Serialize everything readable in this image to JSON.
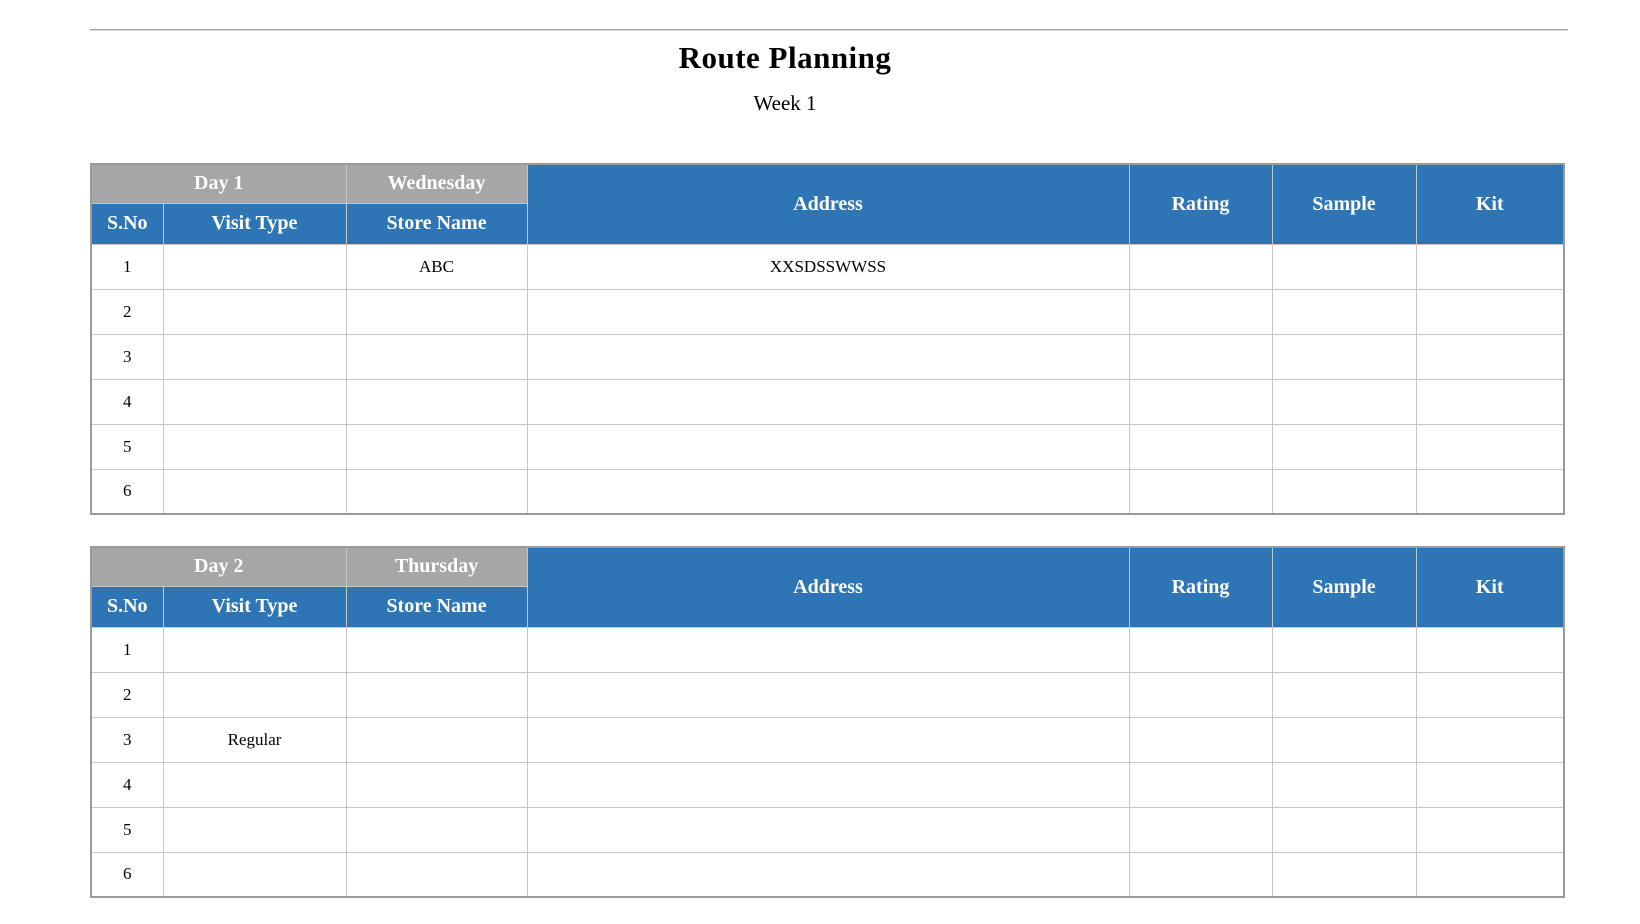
{
  "header": {
    "title": "Route Planning",
    "subtitle": "Week 1"
  },
  "columns": [
    {
      "key": "sno",
      "label": "S.No"
    },
    {
      "key": "visit_type",
      "label": "Visit Type"
    },
    {
      "key": "store_name",
      "label": "Store Name"
    },
    {
      "key": "address",
      "label": "Address"
    },
    {
      "key": "rating",
      "label": "Rating"
    },
    {
      "key": "sample",
      "label": "Sample"
    },
    {
      "key": "kit",
      "label": "Kit"
    }
  ],
  "tables": [
    {
      "day_label": "Day 1",
      "day_name": "Wednesday",
      "rows": [
        {
          "sno": "1",
          "visit_type": "",
          "store_name": "ABC",
          "address": "XXSDSSWWSS",
          "rating": "",
          "sample": "",
          "kit": ""
        },
        {
          "sno": "2",
          "visit_type": "",
          "store_name": "",
          "address": "",
          "rating": "",
          "sample": "",
          "kit": ""
        },
        {
          "sno": "3",
          "visit_type": "",
          "store_name": "",
          "address": "",
          "rating": "",
          "sample": "",
          "kit": ""
        },
        {
          "sno": "4",
          "visit_type": "",
          "store_name": "",
          "address": "",
          "rating": "",
          "sample": "",
          "kit": ""
        },
        {
          "sno": "5",
          "visit_type": "",
          "store_name": "",
          "address": "",
          "rating": "",
          "sample": "",
          "kit": ""
        },
        {
          "sno": "6",
          "visit_type": "",
          "store_name": "",
          "address": "",
          "rating": "",
          "sample": "",
          "kit": ""
        }
      ]
    },
    {
      "day_label": "Day 2",
      "day_name": "Thursday",
      "rows": [
        {
          "sno": "1",
          "visit_type": "",
          "store_name": "",
          "address": "",
          "rating": "",
          "sample": "",
          "kit": ""
        },
        {
          "sno": "2",
          "visit_type": "",
          "store_name": "",
          "address": "",
          "rating": "",
          "sample": "",
          "kit": ""
        },
        {
          "sno": "3",
          "visit_type": "Regular",
          "store_name": "",
          "address": "",
          "rating": "",
          "sample": "",
          "kit": ""
        },
        {
          "sno": "4",
          "visit_type": "",
          "store_name": "",
          "address": "",
          "rating": "",
          "sample": "",
          "kit": ""
        },
        {
          "sno": "5",
          "visit_type": "",
          "store_name": "",
          "address": "",
          "rating": "",
          "sample": "",
          "kit": ""
        },
        {
          "sno": "6",
          "visit_type": "",
          "store_name": "",
          "address": "",
          "rating": "",
          "sample": "",
          "kit": ""
        }
      ]
    }
  ],
  "colors": {
    "header_blue": "#2E75B6",
    "header_gray": "#A6A6A6"
  }
}
